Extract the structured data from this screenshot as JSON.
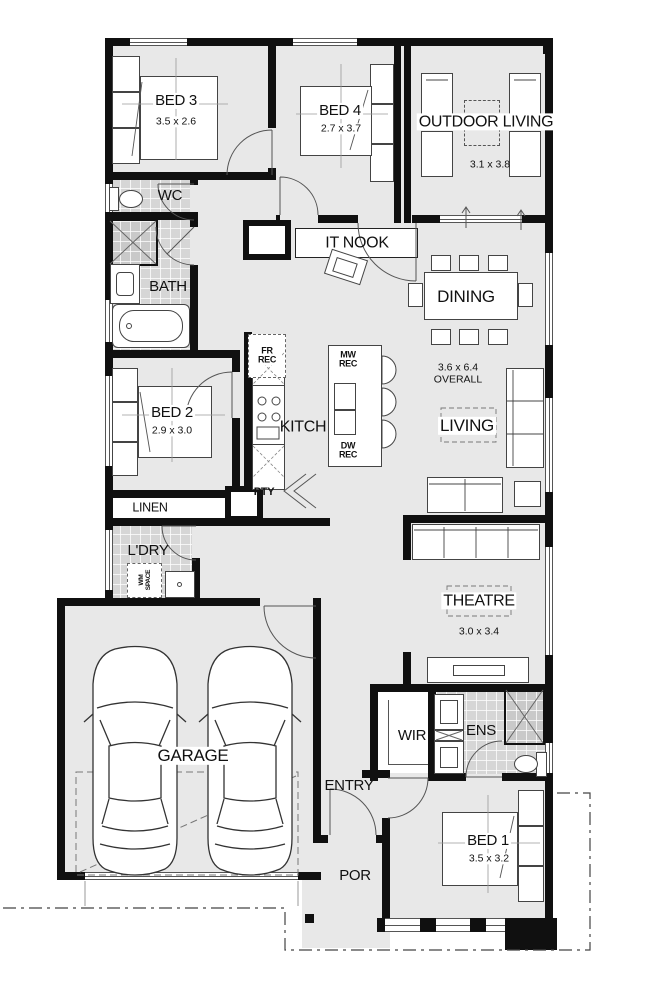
{
  "rooms": {
    "bed3": {
      "name": "BED 3",
      "dims": "3.5 x 2.6"
    },
    "bed4": {
      "name": "BED 4",
      "dims": "2.7 x 3.7"
    },
    "outdoor_living": {
      "name": "OUTDOOR LIVING",
      "dims": "3.1 x 3.8"
    },
    "wc": {
      "name": "WC"
    },
    "it_nook": {
      "name": "IT NOOK"
    },
    "bath": {
      "name": "BATH"
    },
    "dining": {
      "name": "DINING"
    },
    "bed2": {
      "name": "BED 2",
      "dims": "2.9 x 3.0"
    },
    "kitchen": {
      "name": "KITCH"
    },
    "living": {
      "name": "LIVING",
      "overall_dims": "3.6 x 6.4",
      "overall_label": "OVERALL"
    },
    "linen": {
      "name": "LINEN"
    },
    "laundry": {
      "name": "L'DRY",
      "wm_line1": "WM",
      "wm_line2": "SPACE"
    },
    "theatre": {
      "name": "THEATRE",
      "dims": "3.0 x 3.4"
    },
    "garage": {
      "name": "GARAGE"
    },
    "wir": {
      "name": "WIR"
    },
    "ens": {
      "name": "ENS"
    },
    "entry": {
      "name": "ENTRY"
    },
    "bed1": {
      "name": "BED 1",
      "dims": "3.5 x 3.2"
    },
    "porch": {
      "name": "POR"
    }
  },
  "kitchen_labels": {
    "fridge_recess": "FR REC",
    "microwave_recess": "MW REC",
    "dishwasher_recess": "DW REC",
    "pantry": "PTY"
  },
  "colors": {
    "wall": "#101010",
    "floor": "#e8e8e8",
    "wet_area_tile": "#d6d6d6"
  }
}
